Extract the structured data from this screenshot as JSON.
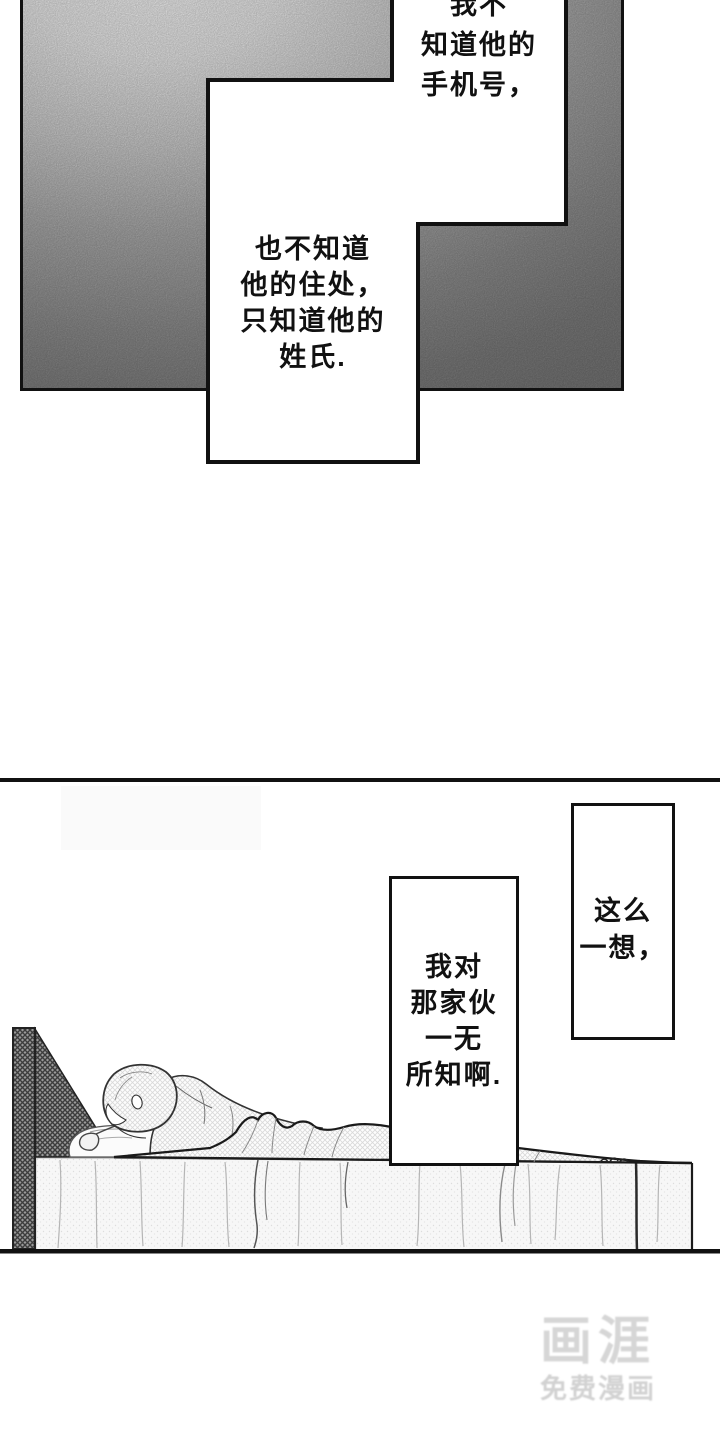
{
  "panel_top": {
    "bubble_phone": {
      "text": "我不\n知道他的\n手机号，"
    },
    "bubble_address": {
      "text": "也不知道\n他的住处，\n只知道他的\n姓氏."
    }
  },
  "panel_bottom": {
    "bubble_think": {
      "text": "这么\n一想，"
    },
    "bubble_know": {
      "text": "我对\n那家伙\n一无\n所知啊."
    }
  },
  "watermark": {
    "brand": "画涯",
    "tagline": "免费漫画"
  },
  "colors": {
    "ink": "#111111",
    "panel_gray": "#7c7c7c",
    "watermark_gray": "#d6d6d6",
    "background": "#ffffff"
  }
}
